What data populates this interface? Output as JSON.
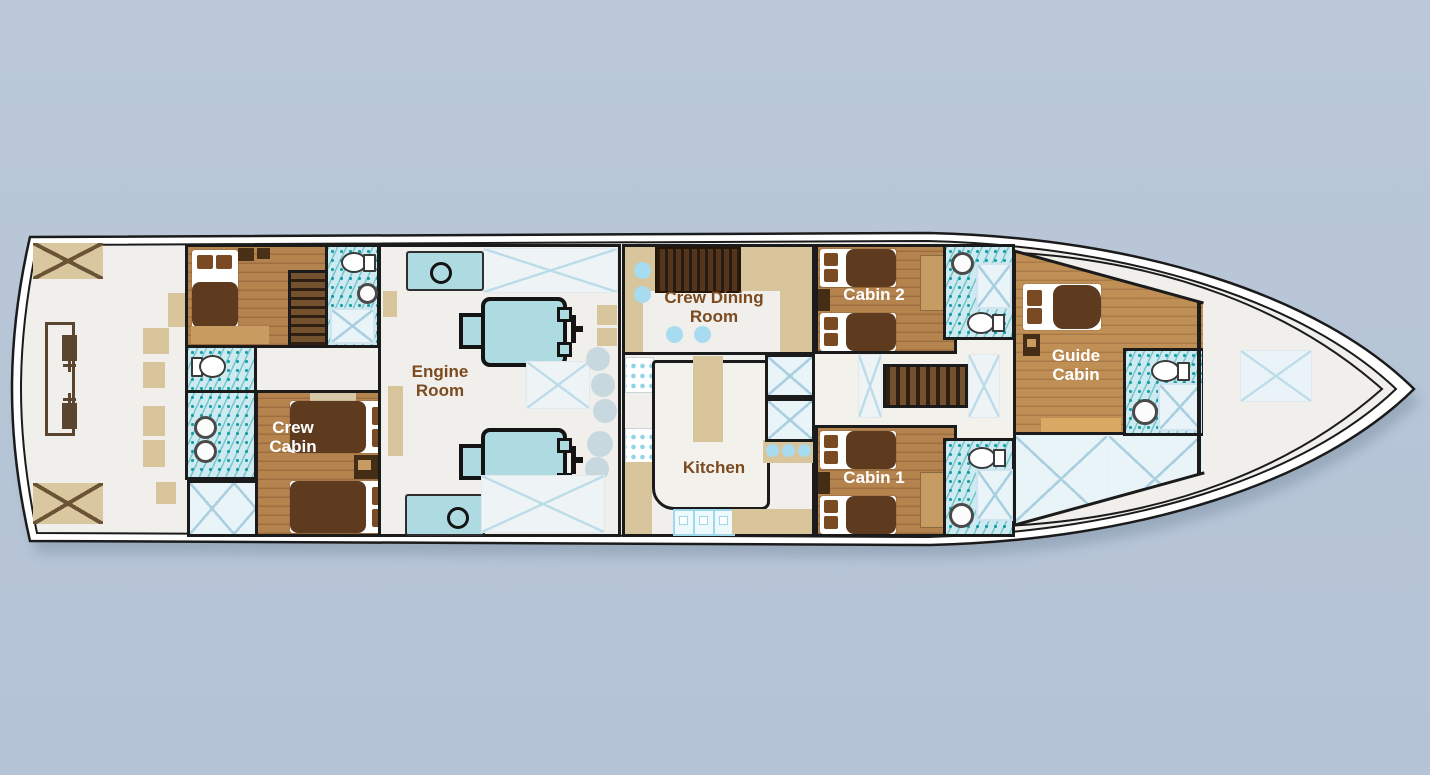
{
  "title": "Yacht lower deck floor plan",
  "deck": {
    "rooms": [
      {
        "id": "crew_cabin",
        "label": "Crew Cabin"
      },
      {
        "id": "engine_room",
        "label": "Engine Room"
      },
      {
        "id": "crew_dining_room",
        "label": "Crew Dining Room"
      },
      {
        "id": "kitchen",
        "label": "Kitchen"
      },
      {
        "id": "cabin_2",
        "label": "Cabin 2"
      },
      {
        "id": "cabin_1",
        "label": "Cabin 1"
      },
      {
        "id": "guide_cabin",
        "label": "Guide Cabin"
      }
    ],
    "fixtures": [
      "bed-icon",
      "toilet-icon",
      "sink-icon",
      "shower-icon",
      "stairs-icon",
      "engine-icon",
      "generator-icon",
      "dining-table-icon",
      "stool-icon",
      "deck-hatch-icon",
      "counter-icon",
      "stove-icon"
    ]
  },
  "colors": {
    "background": "#b8c6d7",
    "hull_fill": "#ffffff",
    "deck_fill": "#f0efeb",
    "outline": "#1b1b1b",
    "wood": "#b5834e",
    "wood_light": "#c08f55",
    "tan": "#d8c59c",
    "dark_brown": "#5e3b1e",
    "tile_teal": "#18a0a8",
    "tile_bg": "#cdeaf0",
    "engine_blue": "#aedbe1",
    "panel_blue": "#e9f4f9",
    "label_brown": "#7c4a1f",
    "label_white": "#ffffff"
  }
}
